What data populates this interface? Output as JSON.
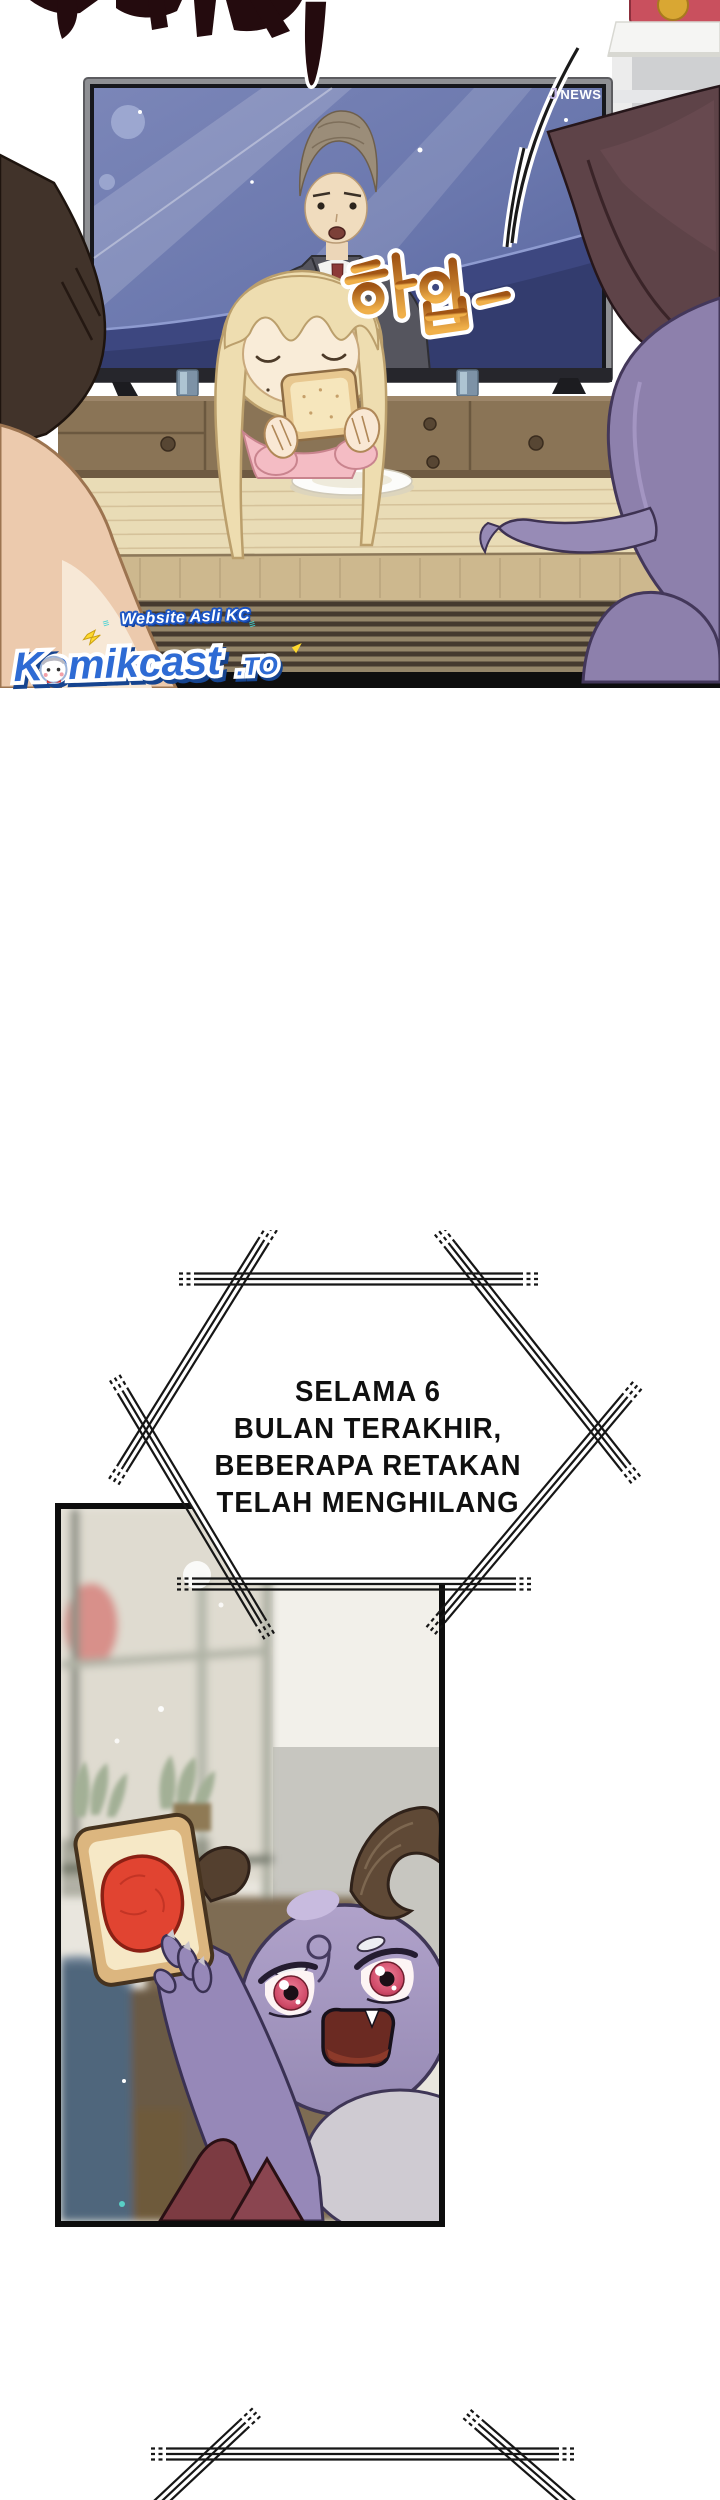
{
  "page": {
    "width": 720,
    "height": 2500,
    "background": "#ffffff",
    "type": "webtoon-comic-page"
  },
  "panel1": {
    "description-name": "living-room-tv-scene",
    "tv_logo": {
      "j": "J",
      "news": "NEWS"
    },
    "sfx_yawn": "하압—"
  },
  "watermark": {
    "tagline": "Website Asli KC",
    "brand": "Komikcast",
    "tld": ".TO",
    "sparkles": "≡",
    "brand_color": "#2e6bd4",
    "outline_color": "#ffffff"
  },
  "bubble1": {
    "lines": [
      "SELAMA 6",
      "BULAN TERAKHIR,",
      "BEBERAPA RETAKAN",
      "TELAH MENGHILANG"
    ]
  },
  "colors": {
    "screen_blue": "#6a77ad",
    "sfx_orange": "#e8982c",
    "demon_purple": "#9688b8",
    "jam_red": "#e0402e",
    "hex_line": "#161616",
    "floor_dark": "#453a2f",
    "cabinet_brown": "#8a7456"
  }
}
